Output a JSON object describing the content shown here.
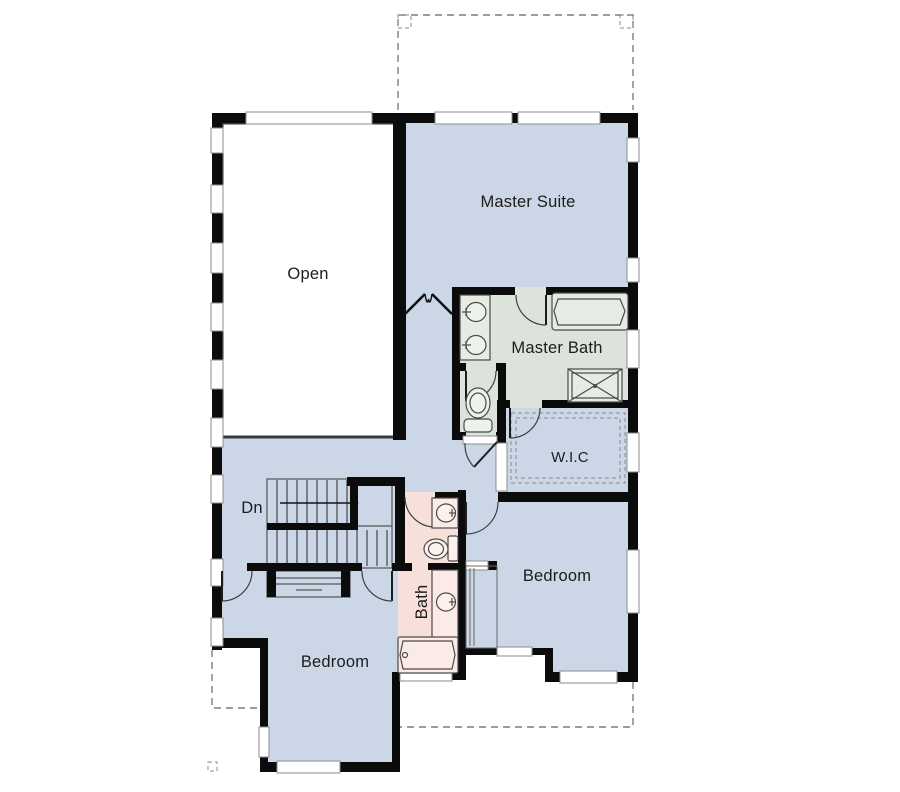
{
  "title": "Second Floor Plan",
  "colors": {
    "room_blue": "#cbd7e6",
    "room_green": "#dce3da",
    "room_pink": "#f7e0da",
    "open_room_white": "#ffffff",
    "wall_black": "#0b0b0b",
    "fixture_green": "#e6ebe4",
    "fixture_pink": "#fbeae6"
  },
  "rooms": {
    "open": {
      "label": "Open"
    },
    "master_suite": {
      "label": "Master Suite"
    },
    "master_bath": {
      "label": "Master Bath"
    },
    "wic": {
      "label": "W.I.C"
    },
    "bedroom_right": {
      "label": "Bedroom"
    },
    "bedroom_left": {
      "label": "Bedroom"
    },
    "bath": {
      "label": "Bath"
    }
  },
  "stairs": {
    "label": "Dn"
  }
}
